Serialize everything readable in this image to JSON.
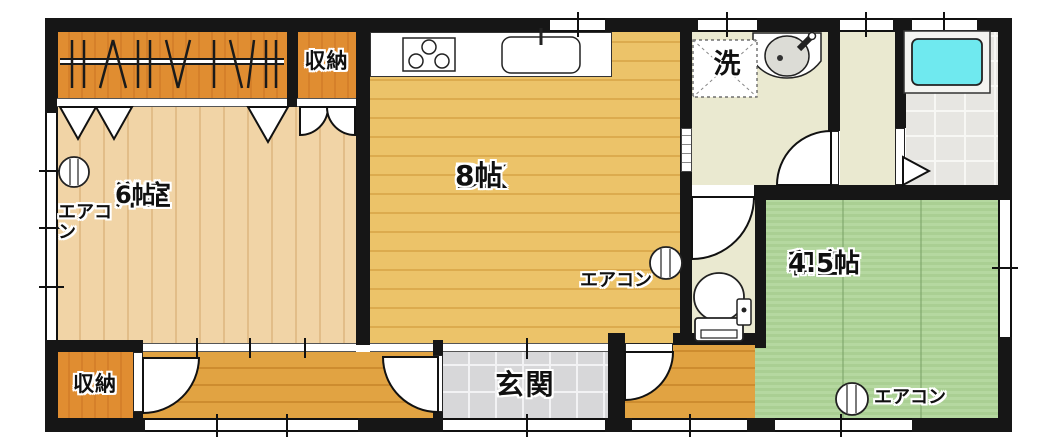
{
  "rooms": {
    "western_room": {
      "name": "洋室",
      "size": "6帖"
    },
    "dining_kitchen": {
      "name": "DK",
      "size": "8帖"
    },
    "japanese_room": {
      "name": "和室",
      "size": "4.5帖"
    },
    "storage_top": {
      "name": "収納"
    },
    "storage_bottom": {
      "name": "収納"
    },
    "entrance": {
      "name": "玄関"
    },
    "laundry_mark": {
      "name": "洗"
    }
  },
  "labels": {
    "air_conditioner": "エアコン"
  },
  "fixtures": [
    "gas-stove",
    "kitchen-sink",
    "vanity-basin",
    "washing-machine-pan",
    "toilet",
    "bathtub",
    "air-conditioner-unit",
    "closet-hanger-rod"
  ],
  "colors": {
    "wall": "#161616",
    "closet_wood": "#e08d31",
    "western_room_floor": "#f1d4a6",
    "dk_floor": "#ecc369",
    "hallway_floor": "#e1a342",
    "tatami": "#b5d8a0",
    "washroom_floor": "#eae9d0",
    "bathroom_tile": "#e7e6e2",
    "entrance_tile": "#d7d7d9",
    "bathtub": "#6fe9ef"
  }
}
